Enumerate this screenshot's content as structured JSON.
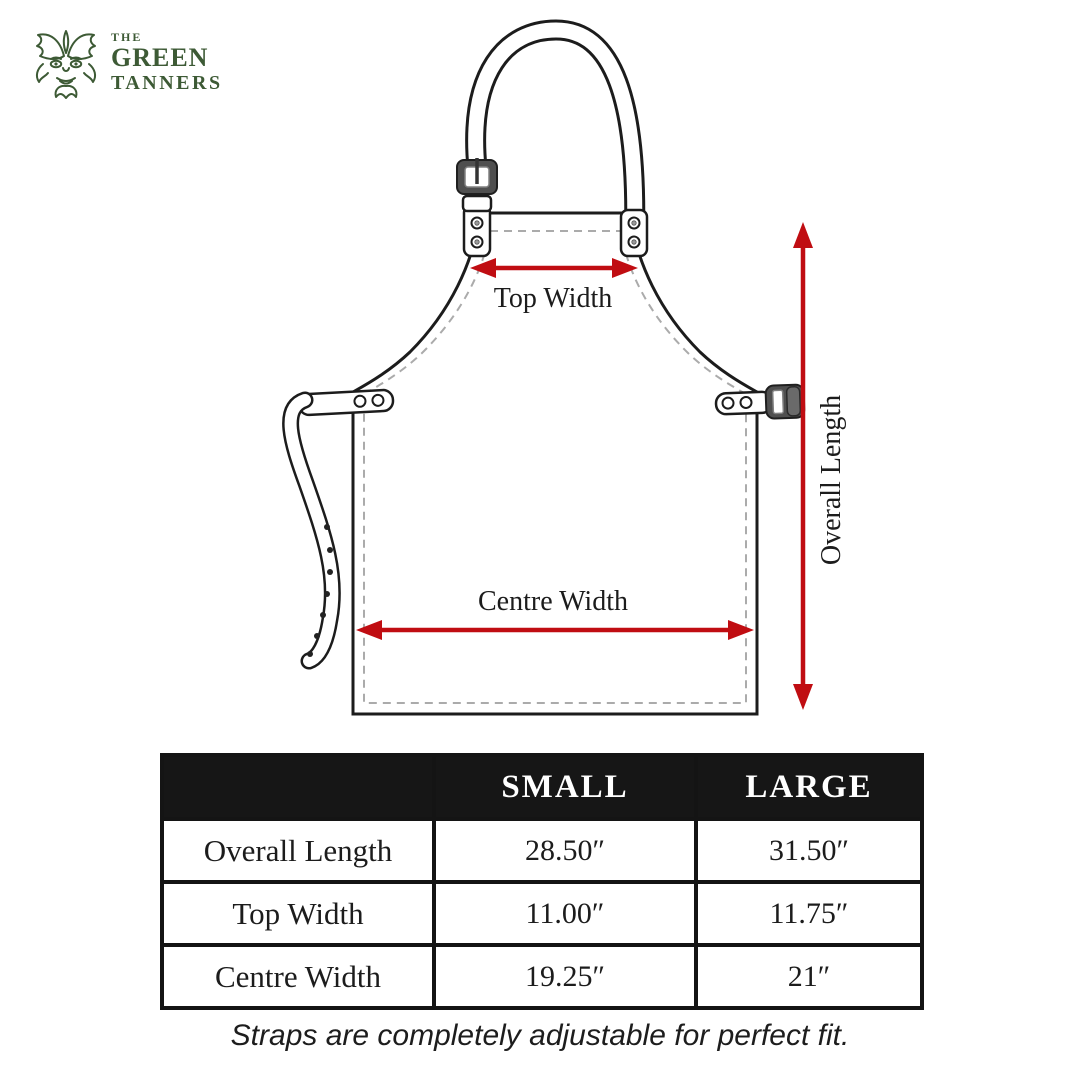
{
  "theme": {
    "brand_green": "#3d5a35",
    "accent_red": "#c00d12",
    "line_ink": "#1c1c1c",
    "stitch_gray": "#ababab",
    "table_header_bg": "#161616",
    "table_header_text": "#ffffff"
  },
  "logo": {
    "brand_top": "THE",
    "brand_main": "GREEN",
    "brand_bottom": "TANNERS"
  },
  "diagram": {
    "labels": {
      "top_width": "Top Width",
      "centre_width": "Centre Width",
      "overall_length": "Overall Length"
    }
  },
  "size_table": {
    "columns": [
      "",
      "SMALL",
      "LARGE"
    ],
    "rows": [
      {
        "label": "Overall Length",
        "small": "28.50″",
        "large": "31.50″"
      },
      {
        "label": "Top Width",
        "small": "11.00″",
        "large": "11.75″"
      },
      {
        "label": "Centre Width",
        "small": "19.25″",
        "large": "21″"
      }
    ]
  },
  "footer": {
    "note": "Straps are completely adjustable for perfect fit."
  }
}
